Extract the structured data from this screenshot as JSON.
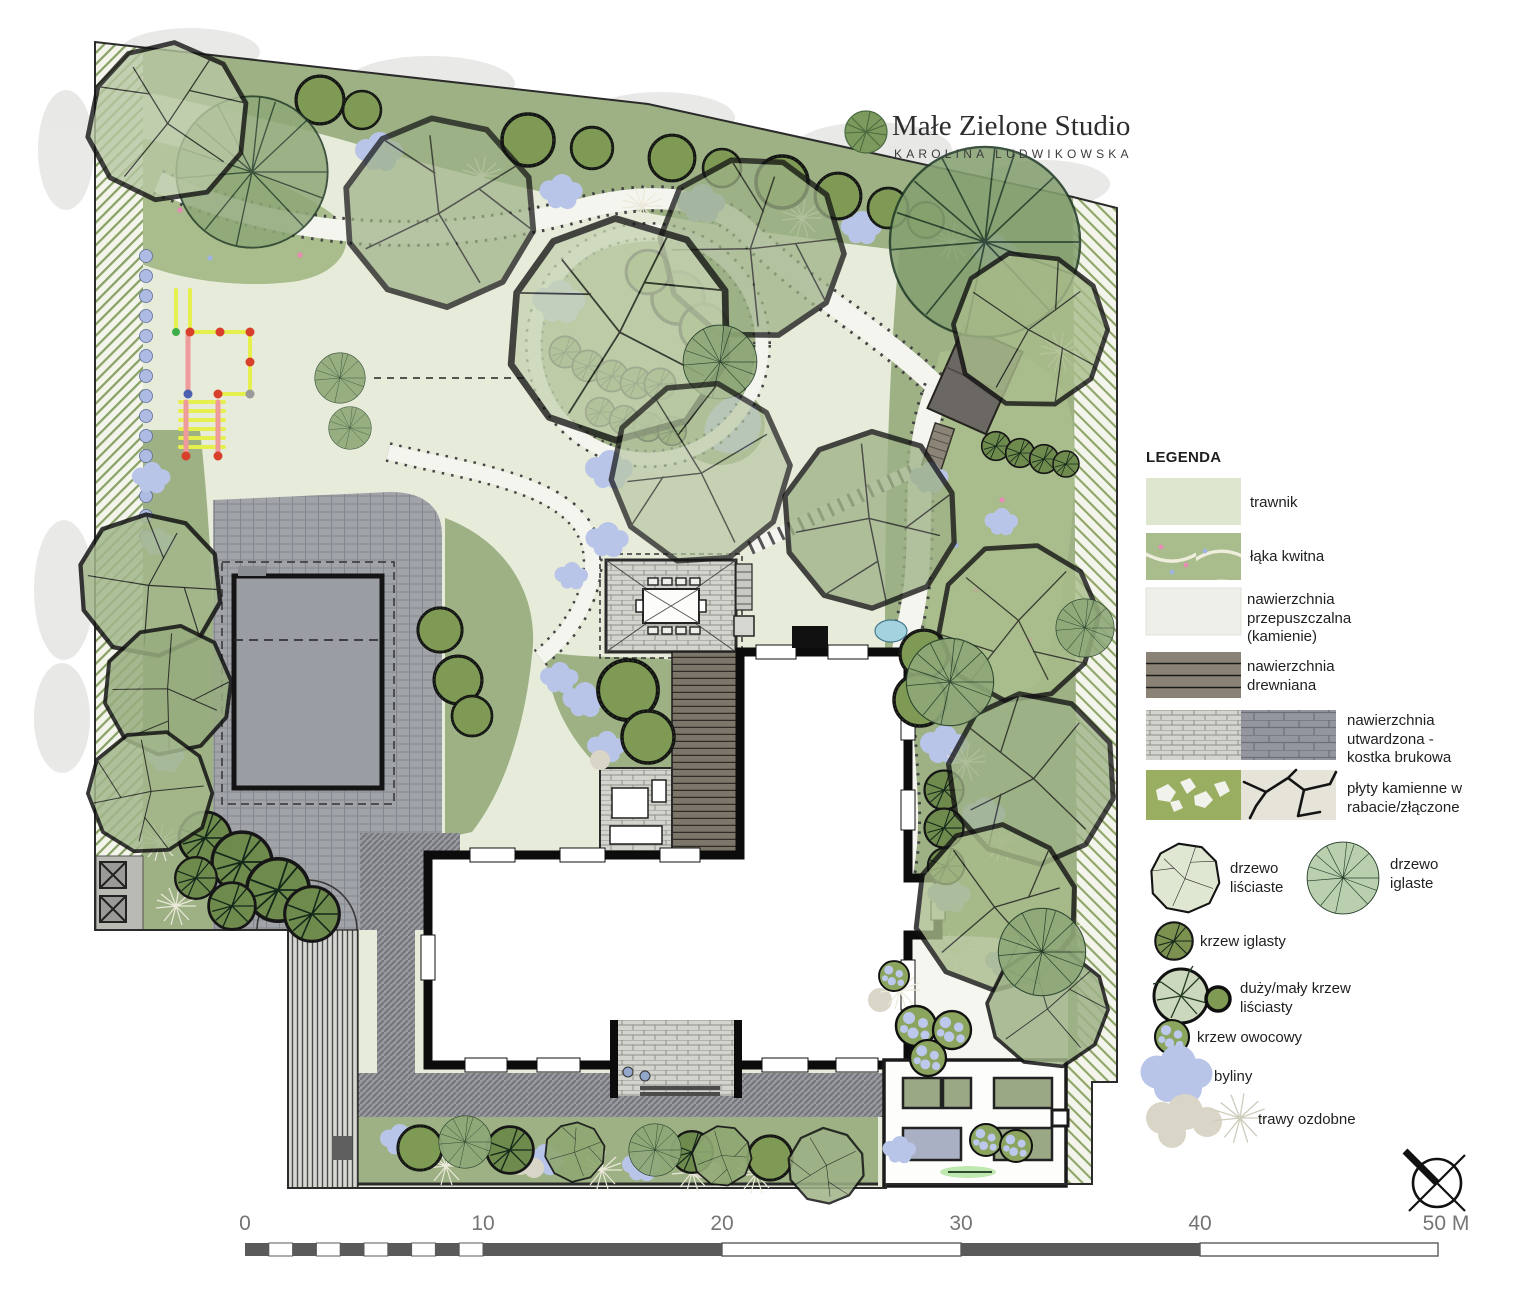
{
  "logo": {
    "studio_name": "Małe Zielone Studio",
    "author": "KAROLINA LUDWIKOWSKA"
  },
  "legend": {
    "title": "LEGENDA",
    "items": [
      {
        "label": "trawnik"
      },
      {
        "label": "łąka kwitna"
      },
      {
        "label": "nawierzchnia przepuszczalna (kamienie)"
      },
      {
        "label": "nawierzchnia drewniana"
      },
      {
        "label": "nawierzchnia utwardzona - kostka brukowa"
      },
      {
        "label": "płyty kamienne w rabacie/złączone"
      },
      {
        "label": "drzewo liściaste"
      },
      {
        "label": "drzewo iglaste"
      },
      {
        "label": "krzew iglasty"
      },
      {
        "label": "duży/mały krzew liściasty"
      },
      {
        "label": "krzew owocowy"
      },
      {
        "label": "byliny"
      },
      {
        "label": "trawy ozdobne"
      }
    ]
  },
  "scalebar": {
    "labels": [
      "0",
      "10",
      "20",
      "30",
      "40",
      "50 M"
    ]
  },
  "colors": {
    "lawn": "#e7ebda",
    "meadow": "#a9bc8b",
    "planting_bed": "#9db184",
    "perennials_blue": "#b9c5e8",
    "grasses_beige": "#d9d5c7",
    "paving_gray": "#a0a3a8",
    "deck_wood": "#7b756a",
    "house_wall": "#0c0c0c",
    "hatch_green": "#88a163"
  }
}
